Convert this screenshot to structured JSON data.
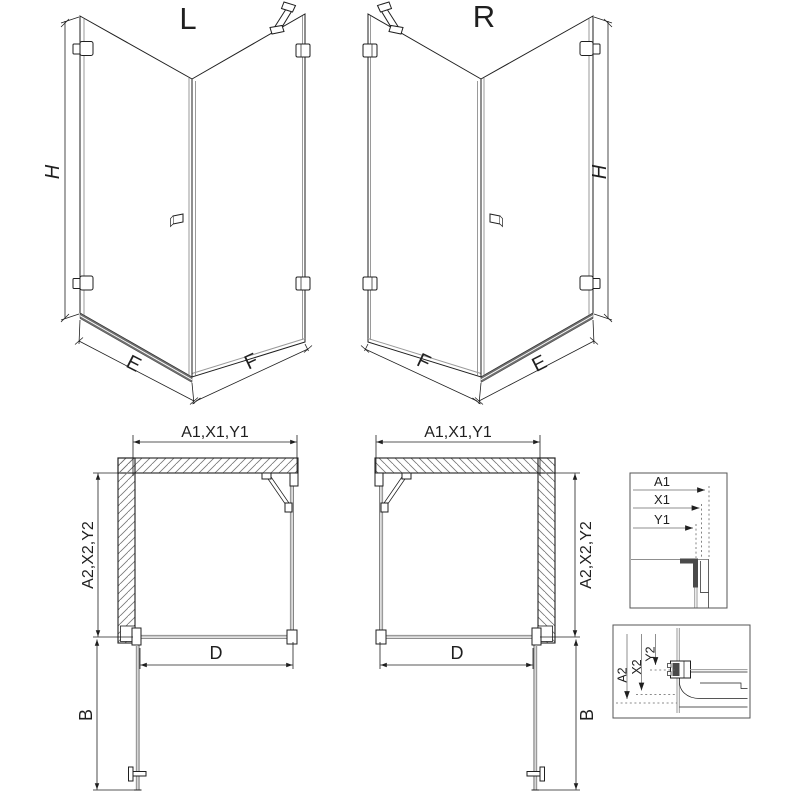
{
  "drawing_title": "Shower enclosure L / R configuration dimension drawing",
  "colors": {
    "line": "#1f1f1f",
    "glass": "#9a9a9a",
    "hatch": "#777777",
    "threshold": "#6f6f6f",
    "frame": "#555555",
    "background": "#ffffff"
  },
  "views": {
    "iso_left": {
      "label": "L",
      "height": "H",
      "door_width": "E",
      "side_width": "F"
    },
    "iso_right": {
      "label": "R",
      "height": "H",
      "door_width": "E",
      "side_width": "F"
    },
    "plan_left": {
      "width_install": "A1,X1,Y1",
      "depth_install": "A2,X2,Y2",
      "fixed_panel": "D",
      "door_swing": "B"
    },
    "plan_right": {
      "width_install": "A1,X1,Y1",
      "depth_install": "A2,X2,Y2",
      "fixed_panel": "D",
      "door_swing": "B"
    },
    "detail_width": {
      "labels": [
        "A1",
        "X1",
        "Y1"
      ]
    },
    "detail_depth": {
      "labels": [
        "A2",
        "X2",
        "Y2"
      ]
    }
  }
}
